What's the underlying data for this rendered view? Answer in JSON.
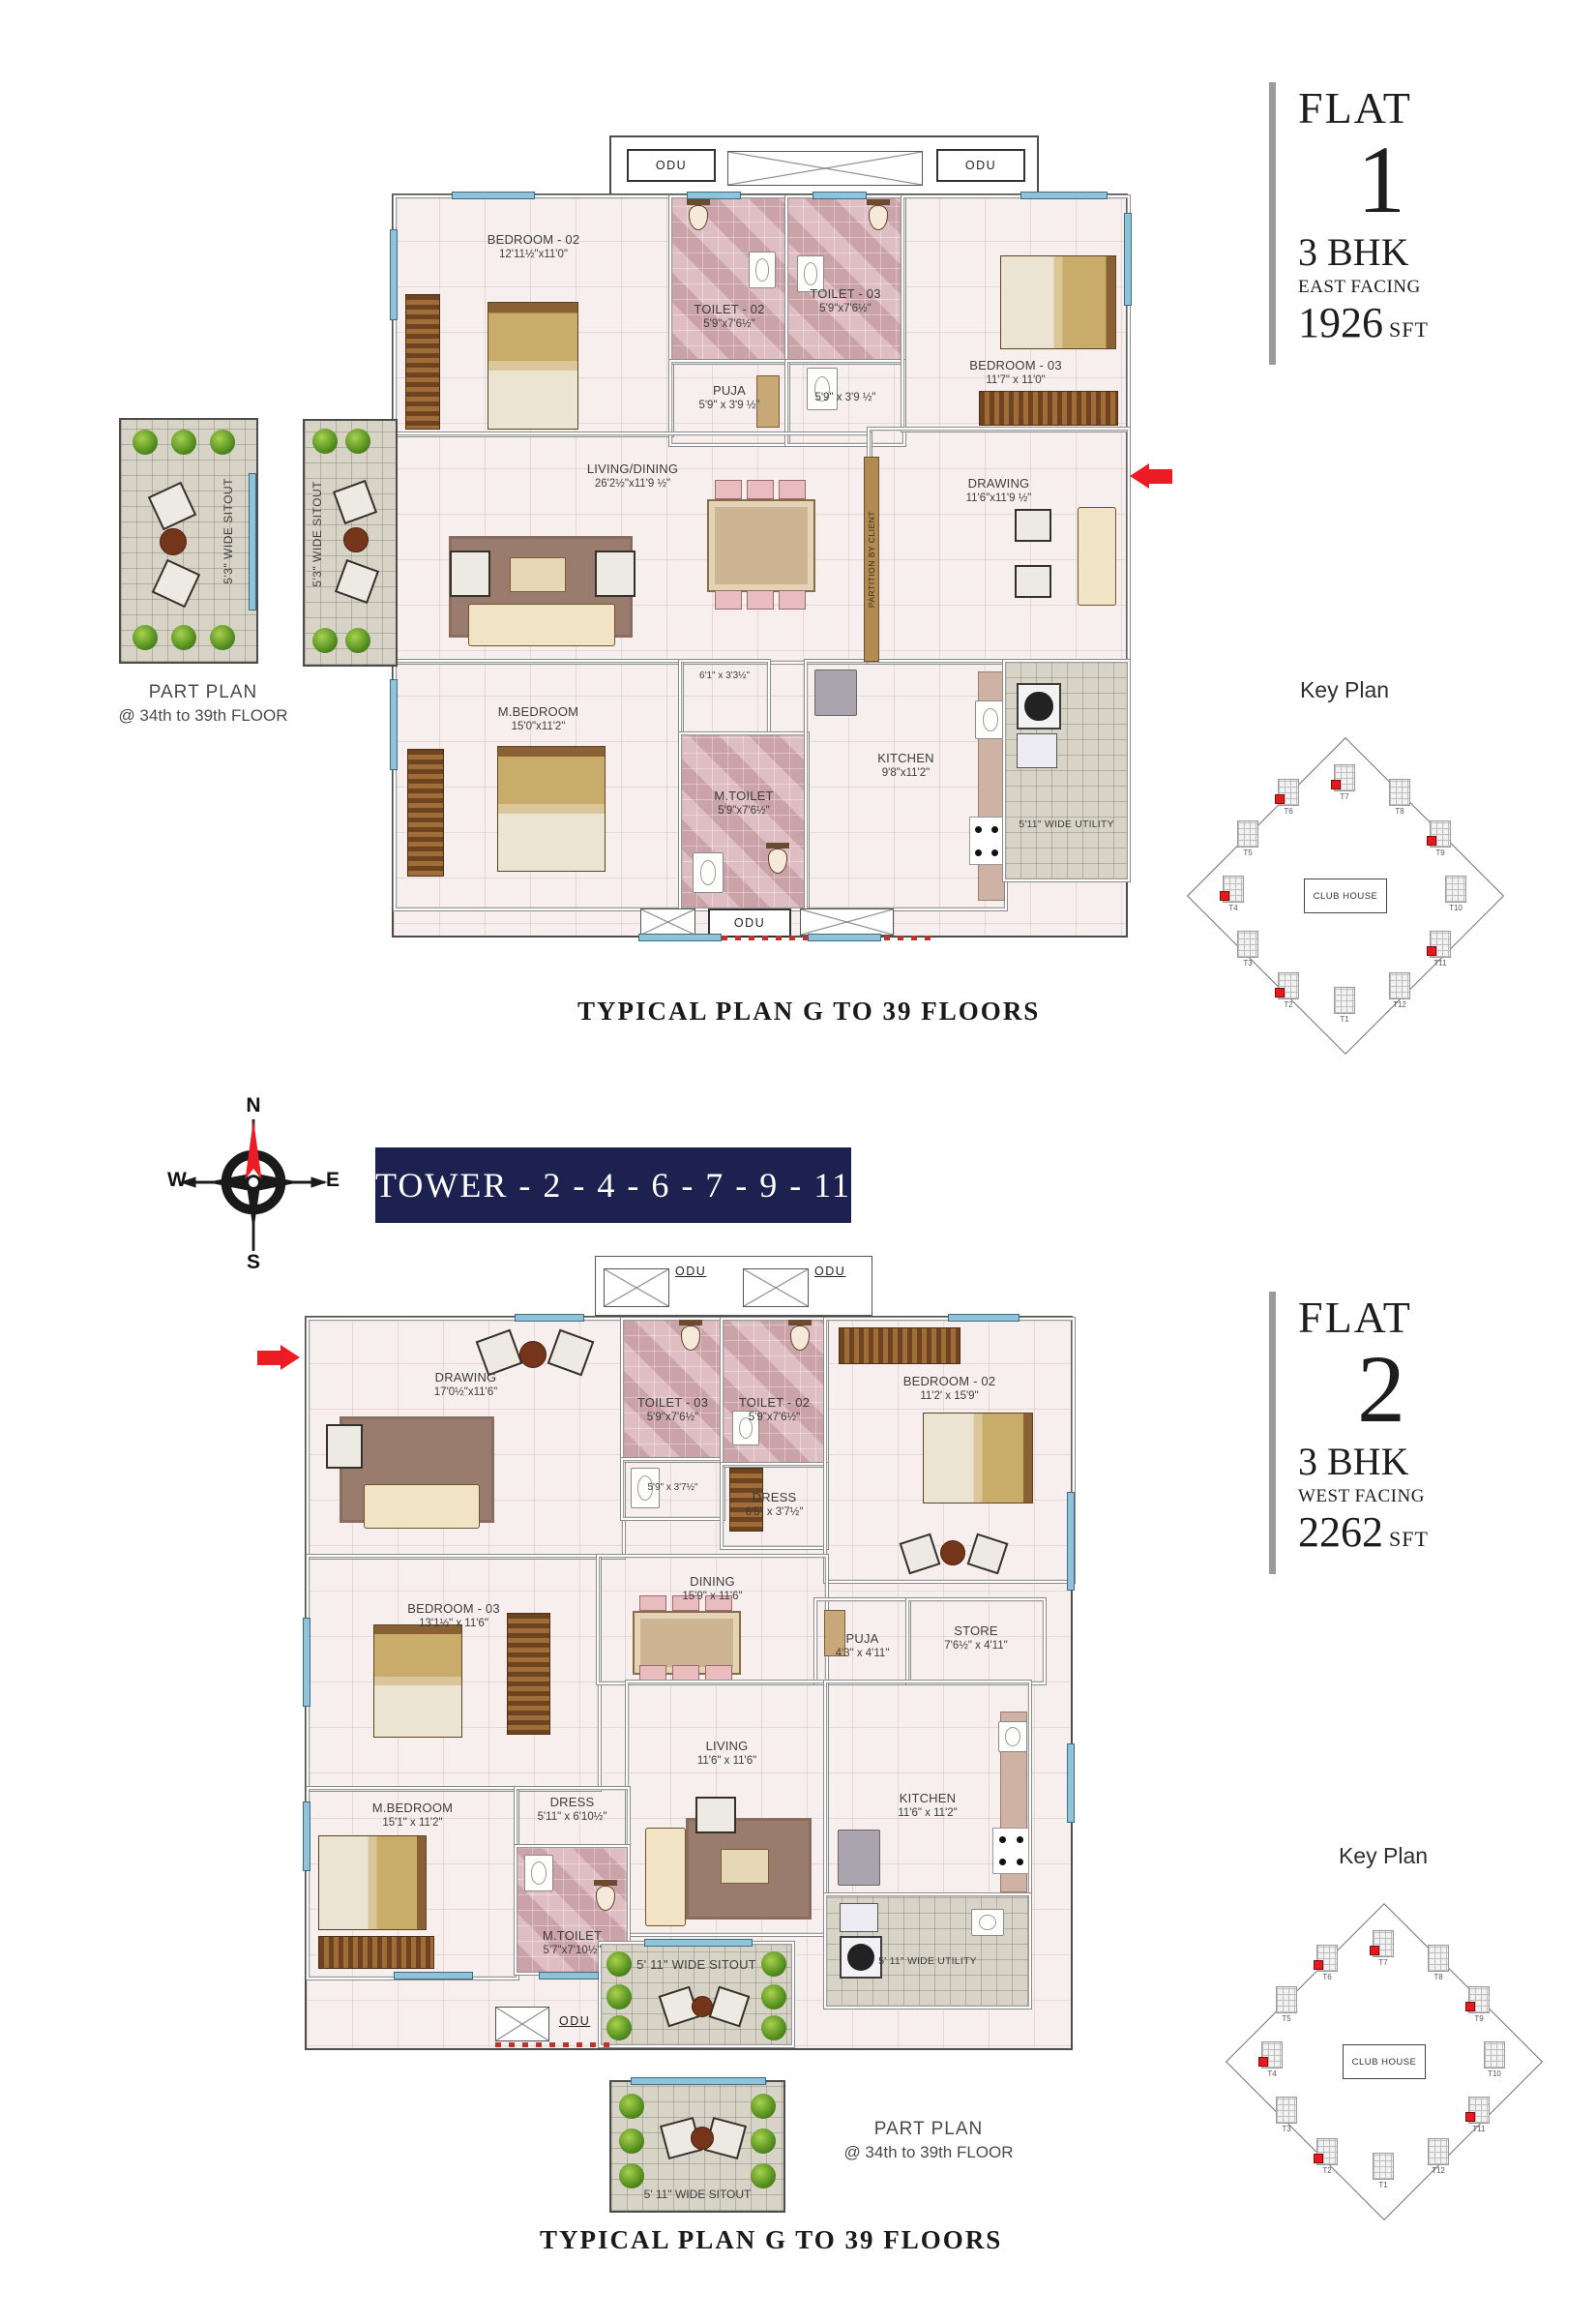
{
  "colors": {
    "accent_red": "#ec1c24",
    "banner_navy": "#1c2150",
    "window_blue": "#8fc3da"
  },
  "captions": {
    "typical_plan": "TYPICAL PLAN  G TO 39 FLOORS"
  },
  "part_plan": {
    "line1": "PART PLAN",
    "line2": "@ 34th to 39th FLOOR"
  },
  "odu_label": "ODU",
  "compass": {
    "n": "N",
    "e": "E",
    "s": "S",
    "w": "W"
  },
  "tower_banner": "TOWER - 2 - 4 - 6 - 7 - 9 - 11",
  "key_plan": {
    "title": "Key Plan",
    "club_house": "CLUB HOUSE",
    "towers": [
      "T1",
      "T2",
      "T3",
      "T4",
      "T5",
      "T6",
      "T7",
      "T8",
      "T9",
      "T10",
      "T11",
      "T12"
    ],
    "highlighted_towers": [
      "T2",
      "T4",
      "T6",
      "T7",
      "T9",
      "T11"
    ]
  },
  "flat1": {
    "label": "FLAT",
    "number": "1",
    "type": "3 BHK",
    "facing": "EAST FACING",
    "area": "1926",
    "area_unit": "SFT",
    "sitout_label": "5'3\" WIDE SITOUT",
    "partition_label": "PARTITION BY CLIENT",
    "rooms": [
      {
        "name": "BEDROOM - 02",
        "dims": "12'11½\"x11'0\""
      },
      {
        "name": "TOILET - 02",
        "dims": "5'9\"x7'6½\""
      },
      {
        "name": "TOILET - 03",
        "dims": "5'9\"x7'6½\""
      },
      {
        "name": "PUJA",
        "dims": "5'9\" x 3'9 ½\""
      },
      {
        "name": "",
        "dims": "5'9\" x 3'9 ½\""
      },
      {
        "name": "BEDROOM - 03",
        "dims": "11'7\" x 11'0\""
      },
      {
        "name": "LIVING/DINING",
        "dims": "26'2½\"x11'9 ½\""
      },
      {
        "name": "DRAWING",
        "dims": "11'6\"x11'9 ½\""
      },
      {
        "name": "M.BEDROOM",
        "dims": "15'0\"x11'2\""
      },
      {
        "name": "",
        "dims": "6'1\" x 3'3½\""
      },
      {
        "name": "M.TOILET",
        "dims": "5'9\"x7'6½\""
      },
      {
        "name": "KITCHEN",
        "dims": "9'8\"x11'2\""
      },
      {
        "name": "5'11\" WIDE UTILITY",
        "dims": ""
      }
    ]
  },
  "flat2": {
    "label": "FLAT",
    "number": "2",
    "type": "3 BHK",
    "facing": "WEST FACING",
    "area": "2262",
    "area_unit": "SFT",
    "sitout_label": "5' 11\" WIDE SITOUT",
    "rooms": [
      {
        "name": "DRAWING",
        "dims": "17'0½\"x11'6\""
      },
      {
        "name": "TOILET - 03",
        "dims": "5'9\"x7'6½\""
      },
      {
        "name": "TOILET - 02",
        "dims": "5'9\"x7'6½\""
      },
      {
        "name": "",
        "dims": "5'9\" x 3'7½\""
      },
      {
        "name": "DRESS",
        "dims": "6'5\" x 3'7½\""
      },
      {
        "name": "BEDROOM - 02",
        "dims": "11'2' x 15'9\""
      },
      {
        "name": "BEDROOM - 03",
        "dims": "13'1½\" x 11'6\""
      },
      {
        "name": "DINING",
        "dims": "15'9\" x 11'6\""
      },
      {
        "name": "PUJA",
        "dims": "4'3\" x 4'11\""
      },
      {
        "name": "STORE",
        "dims": "7'6½\" x 4'11\""
      },
      {
        "name": "LIVING",
        "dims": "11'6\" x 11'6\""
      },
      {
        "name": "KITCHEN",
        "dims": "11'6\" x 11'2\""
      },
      {
        "name": "M.BEDROOM",
        "dims": "15'1\" x 11'2\""
      },
      {
        "name": "DRESS",
        "dims": "5'11\" x 6'10½\""
      },
      {
        "name": "M.TOILET",
        "dims": "5'7\"x7'10½\""
      },
      {
        "name": "5' 11\" WIDE SITOUT",
        "dims": ""
      },
      {
        "name": "5' 11\" WIDE UTILITY",
        "dims": ""
      }
    ]
  }
}
